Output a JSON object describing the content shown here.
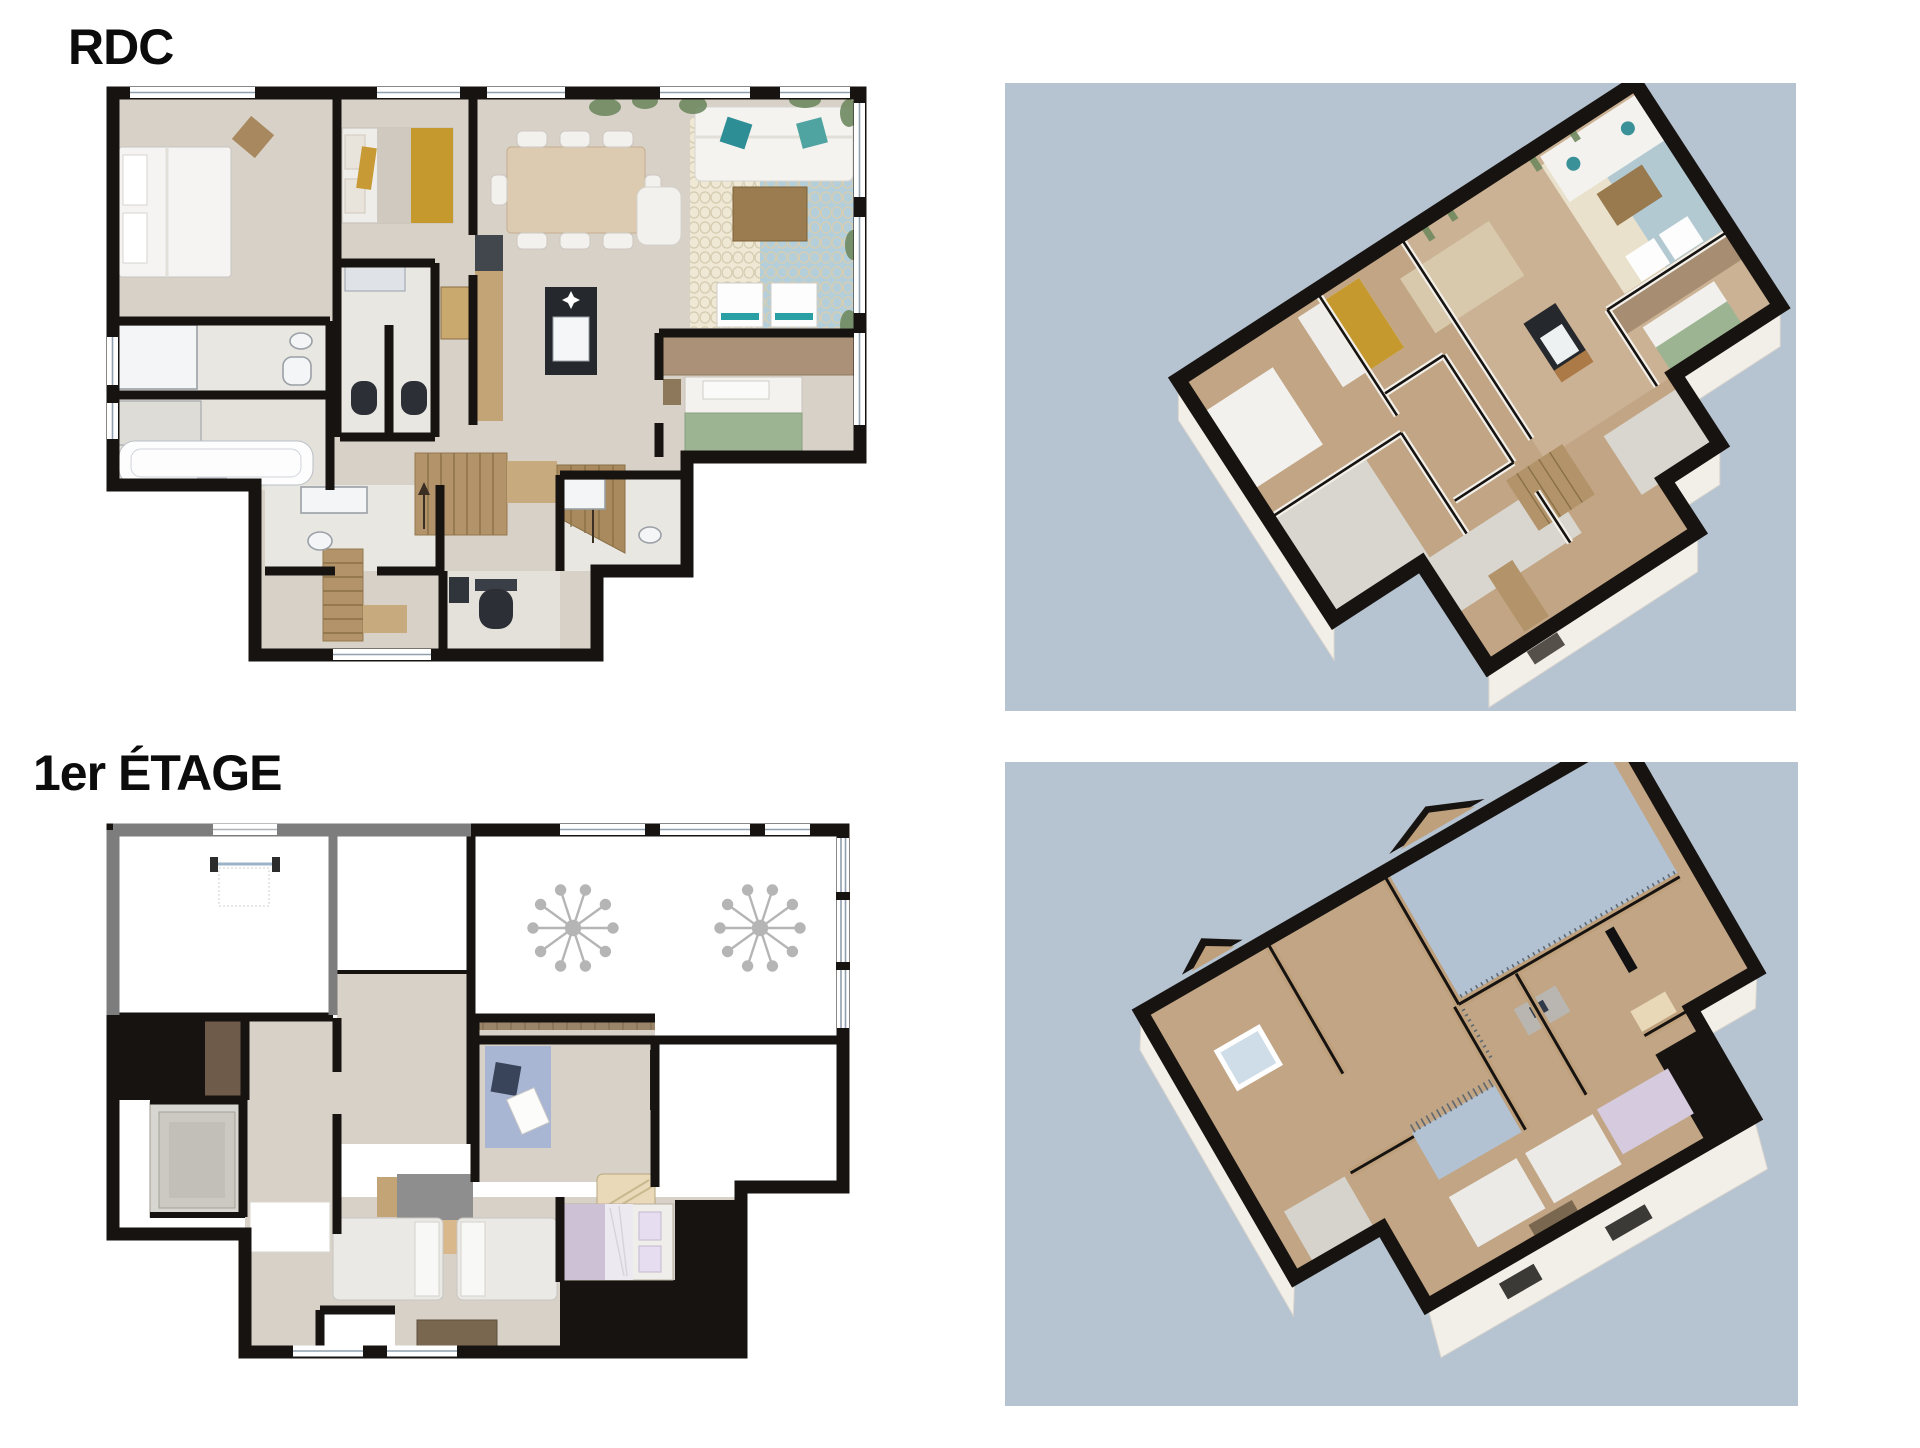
{
  "sheet": {
    "width": 1920,
    "height": 1448,
    "background": "#ffffff"
  },
  "labels": {
    "ground_floor": "RDC",
    "first_floor": "1er ÉTAGE"
  },
  "views": {
    "rdc_plan_2d": {
      "floor_label": "RDC",
      "kind": "2D floor plan"
    },
    "rdc_view_3d": {
      "floor_label": "RDC",
      "kind": "3D floor plan",
      "background": "#b6c3d1"
    },
    "etage_plan_2d": {
      "floor_label": "1er ÉTAGE",
      "kind": "2D floor plan"
    },
    "etage_view_3d": {
      "floor_label": "1er ÉTAGE",
      "kind": "3D floor plan",
      "background": "#b6c3d1"
    }
  },
  "colors": {
    "bg": "#ffffff",
    "panel": "#b6c3d1",
    "wall": "#171310",
    "wallGray": "#7d7d7d",
    "wood": "#d8d1c7",
    "tile": "#e9e7e2",
    "tile2": "#e3e1da",
    "stair": "#b3946a",
    "stair2": "#c7aa7d",
    "rugCream": "#efe8d5",
    "rugBlue": "#a9c9da",
    "mustard": "#c6992f",
    "teal": "#2f9097",
    "greenBed": "#9cb492",
    "lavender": "#cdc1d6",
    "officeRug": "#a9b6d3",
    "wood3d": "#c1a584",
    "wood3dWall": "#bfa07c",
    "white3d": "#f2efe9",
    "island": "#25282c",
    "plant": "#6f8a62",
    "glass": "#a9bccb",
    "ink": "#0c0c0c"
  }
}
